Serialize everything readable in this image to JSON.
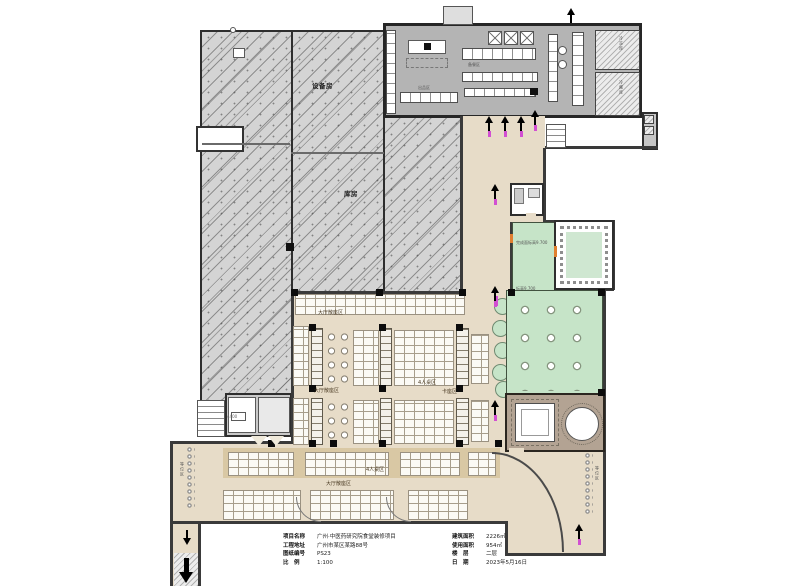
{
  "plan": {
    "accent_magenta": "#d24fd2",
    "dining_beige": "#e7dcc8",
    "terrace_green": "#c6e4c8",
    "vip_tan": "#b3a393",
    "hatch_gray": "#d4d4d4",
    "labels": [
      {
        "text": "设备房"
      },
      {
        "text": "库房"
      },
      {
        "text": "出品区"
      },
      {
        "text": "备餐区"
      },
      {
        "text": "大厅散座区"
      },
      {
        "text": "大厅散座区"
      },
      {
        "text": "4人桌区"
      },
      {
        "text": "卡座区"
      },
      {
        "text": "4人桌区"
      },
      {
        "text": "大厅散座区"
      },
      {
        "text": "完成面标高9.700"
      },
      {
        "text": "标高9.700"
      },
      {
        "text": "冷冻库"
      },
      {
        "text": "冷藏库"
      },
      {
        "text": "等位区"
      },
      {
        "text": "等位区"
      },
      {
        "text": "4400"
      }
    ],
    "title_block": {
      "rows_left": [
        {
          "label": "项目名称",
          "value": "广州·中医药研究院食堂装修项目"
        },
        {
          "label": "工程地址",
          "value": "广州市某区某路88号"
        },
        {
          "label": "图纸编号",
          "value": "PS23"
        },
        {
          "label": "比　例",
          "value": "1:100"
        }
      ],
      "rows_right": [
        {
          "label": "建筑面积",
          "value": "2226㎡"
        },
        {
          "label": "使用面积",
          "value": "954㎡"
        },
        {
          "label": "楼　层",
          "value": "二层"
        },
        {
          "label": "日　期",
          "value": "2023年5月16日"
        }
      ]
    }
  }
}
